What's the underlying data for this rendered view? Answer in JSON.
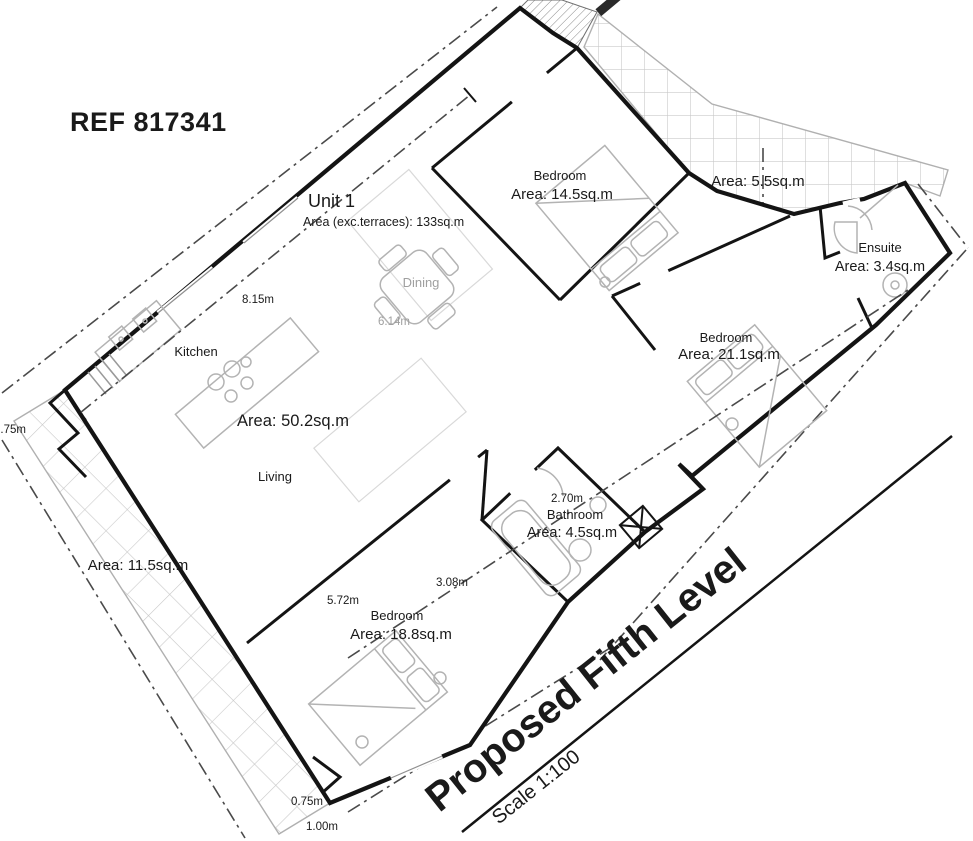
{
  "document": {
    "ref": "REF 817341"
  },
  "unit": {
    "name": "Unit 1",
    "area_note": "Area (exc.terraces): 133sq.m"
  },
  "rooms": {
    "bedroom_top": {
      "name": "Bedroom",
      "area": "Area: 14.5sq.m"
    },
    "bedroom_right": {
      "name": "Bedroom",
      "area": "Area: 21.1sq.m"
    },
    "bedroom_bottom": {
      "name": "Bedroom",
      "area": "Area: 18.8sq.m"
    },
    "ensuite": {
      "name": "Ensuite",
      "area": "Area: 3.4sq.m"
    },
    "bathroom": {
      "name": "Bathroom",
      "area": "Area: 4.5sq.m"
    },
    "living": {
      "name": "Living",
      "area": "Area: 50.2sq.m"
    },
    "kitchen": {
      "name": "Kitchen"
    },
    "dining": {
      "name": "Dining"
    },
    "terrace_side": {
      "area": "Area: 11.5sq.m"
    },
    "terrace_top": {
      "area": "Area: 5.5sq.m"
    }
  },
  "dimensions": {
    "kitchen_wall": "8.15m",
    "dining_span": "6.14m",
    "left_edge": "0.75m",
    "bathroom_span": "2.70m",
    "bedroom_bottom_side": "3.08m",
    "bedroom_bottom_wall": "5.72m",
    "bottom_corner_a": "0.75m",
    "bottom_corner_b": "1.00m"
  },
  "title_block": {
    "title": "Proposed Fifth Level",
    "scale": "Scale 1:100"
  },
  "colors": {
    "wall": "#141414",
    "furniture": "#b3b3b3",
    "tile_pattern": "#c9c9c9",
    "section_line": "#4a4a4a",
    "muted_text": "#9f9f9f",
    "background": "#ffffff"
  }
}
